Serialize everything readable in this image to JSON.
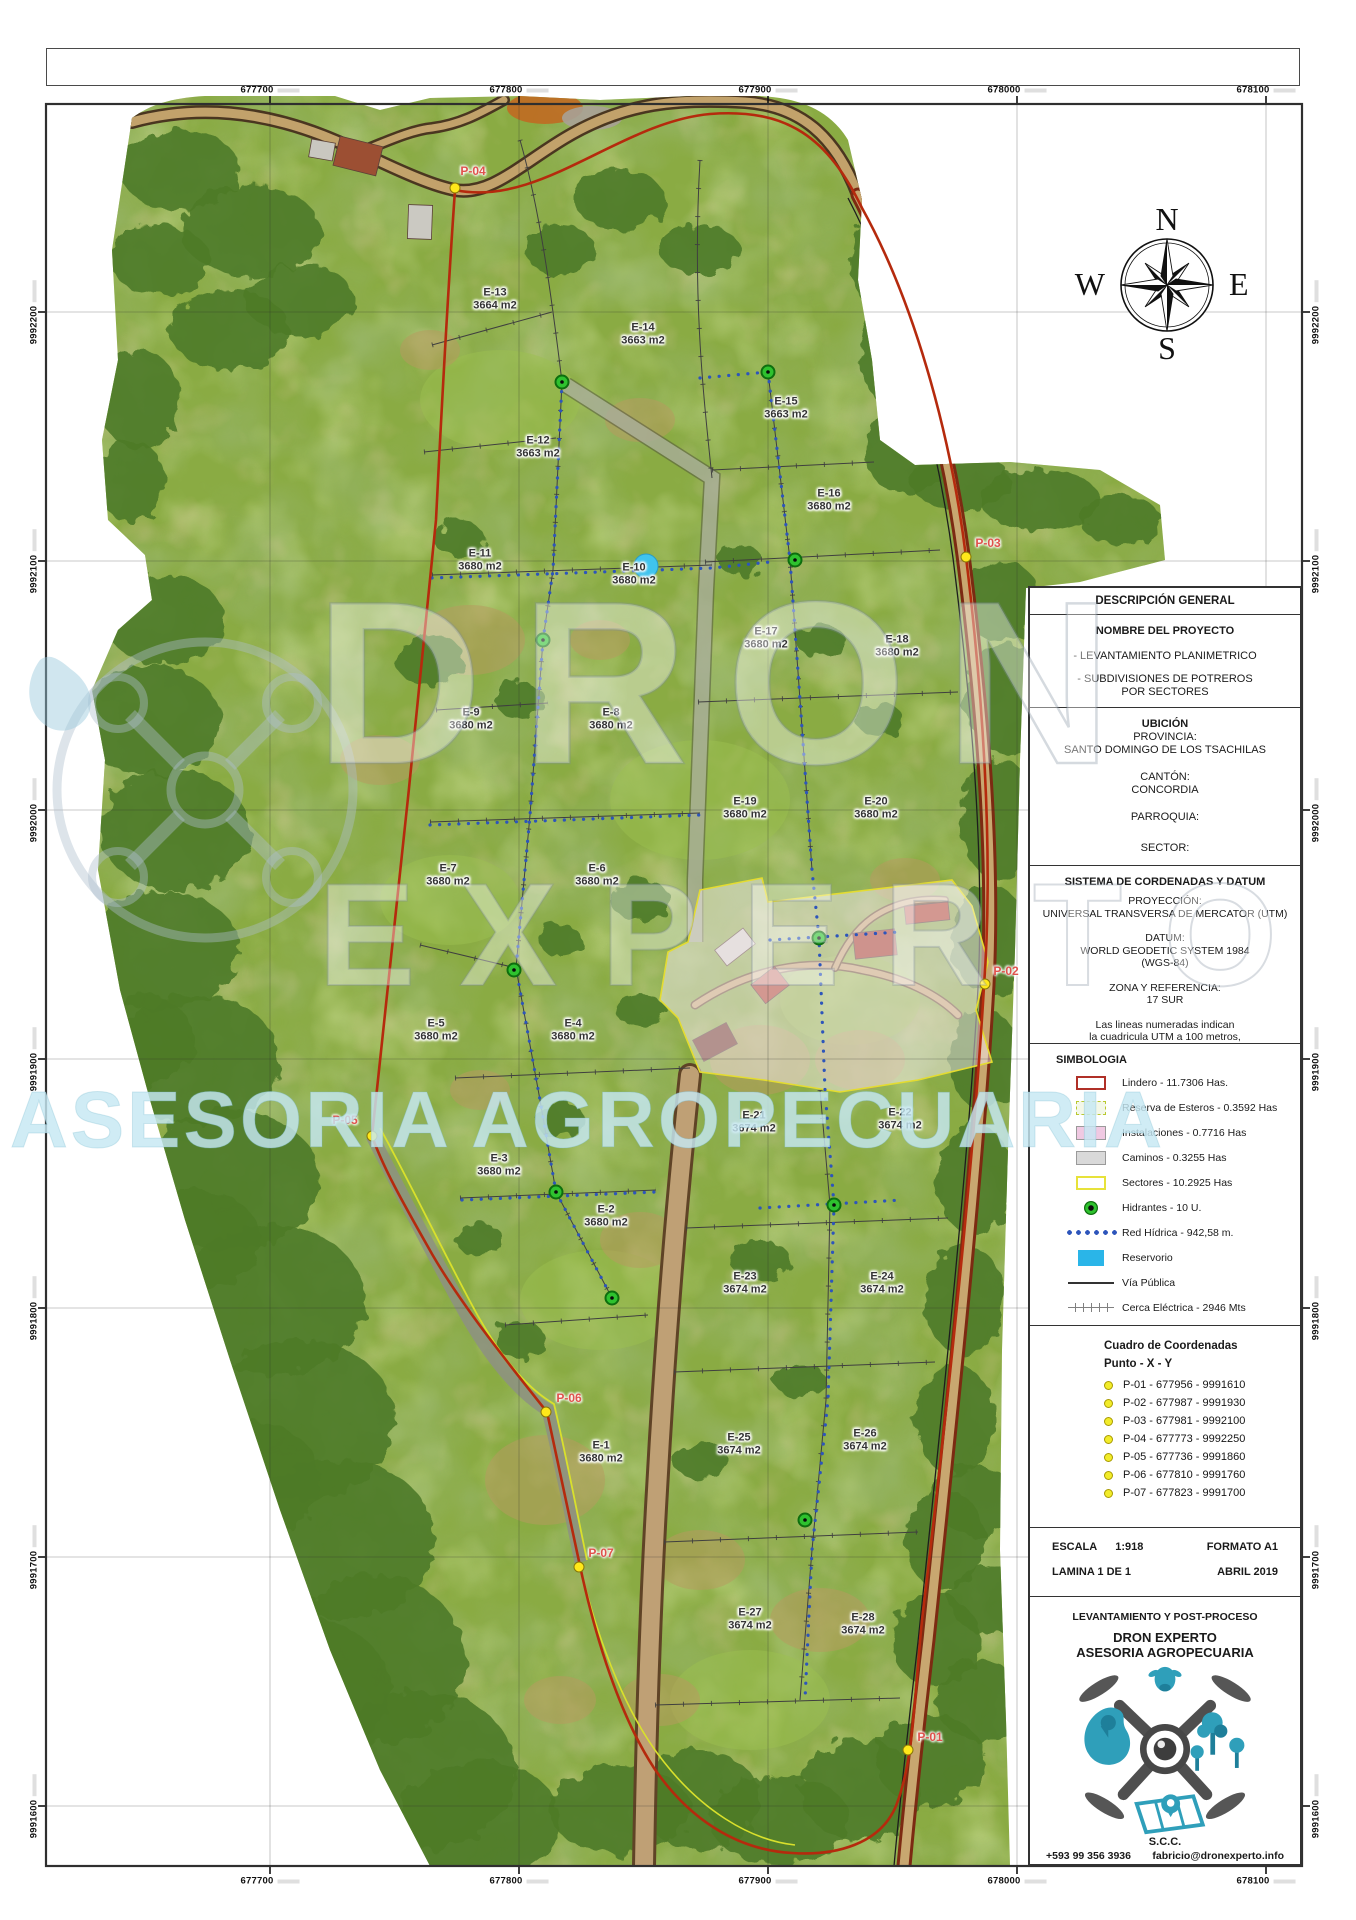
{
  "axes": {
    "x_ticks": [
      {
        "label": "677700",
        "x": 270
      },
      {
        "label": "677800",
        "x": 519
      },
      {
        "label": "677900",
        "x": 768
      },
      {
        "label": "678000",
        "x": 1017
      },
      {
        "label": "678100",
        "x": 1266
      }
    ],
    "y_ticks": [
      {
        "label": "9992200",
        "y": 312
      },
      {
        "label": "9992100",
        "y": 561
      },
      {
        "label": "9992000",
        "y": 810
      },
      {
        "label": "9991900",
        "y": 1059
      },
      {
        "label": "9991800",
        "y": 1308
      },
      {
        "label": "9991700",
        "y": 1557
      },
      {
        "label": "9991600",
        "y": 1806
      }
    ]
  },
  "compass": {
    "n": "N",
    "s": "S",
    "e": "E",
    "w": "W"
  },
  "watermark": {
    "primary": "DRON",
    "secondary": "EXPERTO",
    "tertiary": "ASESORIA AGROPECUARIA"
  },
  "panel": {
    "header": "DESCRIPCIÓN GENERAL",
    "nombre": {
      "title": "NOMBRE DEL PROYECTO",
      "item1": "- LEVANTAMIENTO PLANIMETRICO",
      "item2": "- SUBDIVISIONES DE POTREROS\nPOR SECTORES"
    },
    "ubicacion": {
      "title": "UBICIÓN",
      "rows": [
        {
          "k": "PROVINCIA:",
          "v": "SANTO DOMINGO DE LOS TSACHILAS"
        },
        {
          "k": "CANTÓN:",
          "v": "CONCORDIA"
        },
        {
          "k": "PARROQUIA:",
          "v": ""
        },
        {
          "k": "SECTOR:",
          "v": ""
        }
      ]
    },
    "sistema": {
      "title": "SISTEMA DE CORDENADAS Y DATUM",
      "rows": [
        {
          "k": "PROYECCIÓN:",
          "v": "UNIVERSAL TRANSVERSA DE MERCATOR (UTM)"
        },
        {
          "k": "DATUM:",
          "v": "WORLD GEODETIC SYSTEM 1984\n(WGS-84)"
        },
        {
          "k": "ZONA Y REFERENCIA:",
          "v": "17 SUR"
        }
      ],
      "note": "Las lineas numeradas indican\nla cuadricula UTM a 100 metros,\nZona 17 S"
    },
    "simbologia": {
      "title": "SIMBOLOGIA",
      "items": [
        {
          "swatch": "lindero",
          "label": "Lindero - 11.7306 Has."
        },
        {
          "swatch": "reserva",
          "label": "Reserva de Esteros - 0.3592 Has"
        },
        {
          "swatch": "instalaciones",
          "label": "Instalaciones - 0.7716 Has"
        },
        {
          "swatch": "caminos",
          "label": "Caminos - 0.3255 Has"
        },
        {
          "swatch": "sectores",
          "label": "Sectores - 10.2925 Has"
        },
        {
          "swatch": "hidrantes",
          "label": "Hidrantes - 10 U."
        },
        {
          "swatch": "red-hidrica",
          "label": "Red Hídrica - 942,58 m."
        },
        {
          "swatch": "reservorio",
          "label": "Reservorio"
        },
        {
          "swatch": "via-publica",
          "label": "Vía Pública"
        },
        {
          "swatch": "cerca",
          "label": "Cerca Eléctrica - 2946 Mts"
        }
      ]
    },
    "coordenadas": {
      "title": "Cuadro de Coordenadas",
      "subtitle": "Punto - X - Y",
      "rows": [
        "P-01 - 677956 - 9991610",
        "P-02 - 677987 - 9991930",
        "P-03 - 677981 - 9992100",
        "P-04 - 677773 - 9992250",
        "P-05 - 677736 - 9991860",
        "P-06 - 677810 - 9991760",
        "P-07 - 677823 - 9991700"
      ]
    },
    "escala": {
      "escala_label": "ESCALA",
      "escala_value": "1:918",
      "formato": "FORMATO A1",
      "lamina": "LAMINA 1 DE 1",
      "fecha": "ABRIL 2019"
    },
    "empresa": {
      "header": "LEVANTAMIENTO Y POST-PROCESO",
      "name1": "DRON EXPERTO",
      "name2": "ASESORIA AGROPECUARIA",
      "scc": "S.C.C.",
      "phone": "+593 99 356 3936",
      "email": "fabricio@dronexperto.info"
    }
  },
  "map": {
    "parcels": [
      {
        "id": "E-13",
        "area": "3664 m2",
        "x": 495,
        "y": 299
      },
      {
        "id": "E-14",
        "area": "3663 m2",
        "x": 643,
        "y": 334
      },
      {
        "id": "E-15",
        "area": "3663 m2",
        "x": 786,
        "y": 408
      },
      {
        "id": "E-12",
        "area": "3663 m2",
        "x": 538,
        "y": 447
      },
      {
        "id": "E-16",
        "area": "3680 m2",
        "x": 829,
        "y": 500
      },
      {
        "id": "E-11",
        "area": "3680 m2",
        "x": 480,
        "y": 560
      },
      {
        "id": "E-10",
        "area": "3680 m2",
        "x": 634,
        "y": 574
      },
      {
        "id": "E-17",
        "area": "3680 m2",
        "x": 766,
        "y": 638
      },
      {
        "id": "E-18",
        "area": "3680 m2",
        "x": 897,
        "y": 646
      },
      {
        "id": "E-9",
        "area": "3680 m2",
        "x": 471,
        "y": 719
      },
      {
        "id": "E-8",
        "area": "3680 m2",
        "x": 611,
        "y": 719
      },
      {
        "id": "E-19",
        "area": "3680 m2",
        "x": 745,
        "y": 808
      },
      {
        "id": "E-20",
        "area": "3680 m2",
        "x": 876,
        "y": 808
      },
      {
        "id": "E-7",
        "area": "3680 m2",
        "x": 448,
        "y": 875
      },
      {
        "id": "E-6",
        "area": "3680 m2",
        "x": 597,
        "y": 875
      },
      {
        "id": "E-5",
        "area": "3680 m2",
        "x": 436,
        "y": 1030
      },
      {
        "id": "E-4",
        "area": "3680 m2",
        "x": 573,
        "y": 1030
      },
      {
        "id": "E-21",
        "area": "3674 m2",
        "x": 754,
        "y": 1122
      },
      {
        "id": "E-22",
        "area": "3674 m2",
        "x": 900,
        "y": 1119
      },
      {
        "id": "E-3",
        "area": "3680 m2",
        "x": 499,
        "y": 1165
      },
      {
        "id": "E-2",
        "area": "3680 m2",
        "x": 606,
        "y": 1216
      },
      {
        "id": "E-23",
        "area": "3674 m2",
        "x": 745,
        "y": 1283
      },
      {
        "id": "E-24",
        "area": "3674 m2",
        "x": 882,
        "y": 1283
      },
      {
        "id": "E-1",
        "area": "3680 m2",
        "x": 601,
        "y": 1452
      },
      {
        "id": "E-25",
        "area": "3674 m2",
        "x": 739,
        "y": 1444
      },
      {
        "id": "E-26",
        "area": "3674 m2",
        "x": 865,
        "y": 1440
      },
      {
        "id": "E-27",
        "area": "3674 m2",
        "x": 750,
        "y": 1619
      },
      {
        "id": "E-28",
        "area": "3674 m2",
        "x": 863,
        "y": 1624
      }
    ],
    "points": [
      {
        "id": "P-01",
        "x": 908,
        "y": 1750,
        "lx": 930,
        "ly": 1737
      },
      {
        "id": "P-02",
        "x": 985,
        "y": 984,
        "lx": 1006,
        "ly": 971
      },
      {
        "id": "P-03",
        "x": 966,
        "y": 557,
        "lx": 988,
        "ly": 543
      },
      {
        "id": "P-04",
        "x": 455,
        "y": 188,
        "lx": 473,
        "ly": 171
      },
      {
        "id": "P-05",
        "x": 372,
        "y": 1136,
        "lx": 345,
        "ly": 1120
      },
      {
        "id": "P-06",
        "x": 546,
        "y": 1412,
        "lx": 569,
        "ly": 1398
      },
      {
        "id": "P-07",
        "x": 579,
        "y": 1567,
        "lx": 601,
        "ly": 1553
      }
    ],
    "hydrants": [
      [
        562,
        382
      ],
      [
        543,
        640
      ],
      [
        514,
        970
      ],
      [
        556,
        1192
      ],
      [
        612,
        1298
      ],
      [
        768,
        372
      ],
      [
        795,
        560
      ],
      [
        819,
        938
      ],
      [
        834,
        1205
      ],
      [
        805,
        1520
      ]
    ],
    "reservoir": {
      "x": 646,
      "y": 566
    }
  }
}
